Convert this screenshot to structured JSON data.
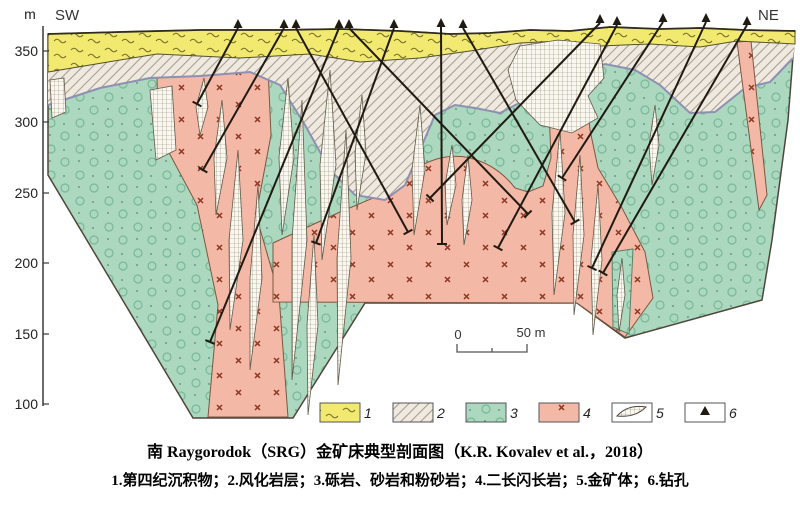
{
  "labels": {
    "sw": "SW",
    "ne": "NE",
    "axis_unit": "m"
  },
  "axis_ticks": [
    {
      "value": "350"
    },
    {
      "value": "300"
    },
    {
      "value": "250"
    },
    {
      "value": "200"
    },
    {
      "value": "150"
    },
    {
      "value": "100"
    }
  ],
  "scalebar": {
    "start": "0",
    "end": "50 m"
  },
  "legend": [
    {
      "num": "1",
      "name": "quaternary-sediments"
    },
    {
      "num": "2",
      "name": "weathered-rock-layer"
    },
    {
      "num": "3",
      "name": "conglomerate-sandstone-siltstone"
    },
    {
      "num": "4",
      "name": "monzodiorite"
    },
    {
      "num": "5",
      "name": "gold-orebody"
    },
    {
      "num": "6",
      "name": "drill-hole"
    }
  ],
  "captions": {
    "title": "南 Raygorodok（SRG）金矿床典型剖面图（K.R. Kovalev et al.，2018）",
    "legend_text": "1.第四纪沉积物；2.风化岩层；3.砾岩、砂岩和粉砂岩；4.二长闪长岩；5.金矿体；6.钻孔"
  },
  "colors": {
    "quaternary": "#f2ea70",
    "weathered": "#efe9e0",
    "sediments": "#abd8bf",
    "monzodiorite": "#f4b9a6",
    "orebody": "#faf7f0",
    "outline": "#4f463b"
  },
  "drills": [
    [
      238,
      28,
      197,
      104
    ],
    [
      284,
      28,
      203,
      170
    ],
    [
      296,
      28,
      408,
      232
    ],
    [
      339,
      28,
      210,
      342
    ],
    [
      349,
      28,
      528,
      214
    ],
    [
      394,
      28,
      316,
      243
    ],
    [
      441,
      27,
      442,
      244
    ],
    [
      463,
      28,
      575,
      222
    ],
    [
      600,
      23,
      430,
      198
    ],
    [
      617,
      25,
      498,
      248
    ],
    [
      663,
      22,
      562,
      178
    ],
    [
      706,
      22,
      592,
      268
    ],
    [
      747,
      25,
      603,
      273
    ]
  ]
}
